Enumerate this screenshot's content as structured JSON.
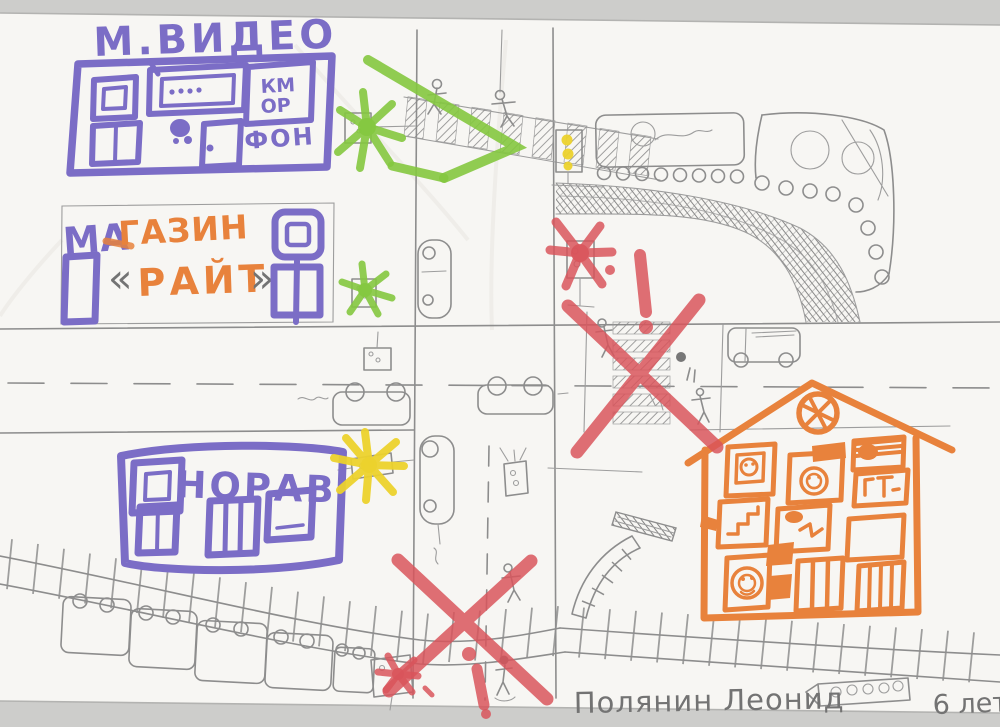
{
  "buildings": {
    "mvideo": {
      "title": "М.ВИДЕО",
      "sign_line1": "КМ",
      "sign_line2": "ОР",
      "sign_line3": "ФОН"
    },
    "magazin_rait": {
      "word_start": "МА",
      "word_end": "ГАЗИН",
      "line2": "РАЙТ",
      "chevron_left": "«",
      "chevron_right": "»"
    },
    "norav": {
      "title": "НОРАВ"
    }
  },
  "signature": {
    "name": "Полянин Леонид",
    "age": "6 лет"
  },
  "markers": [
    {
      "name": "green-arrow",
      "color": "#84c83f"
    },
    {
      "name": "green-star-top-traffic-light",
      "color": "#84c83f"
    },
    {
      "name": "green-star-mid-traffic-light",
      "color": "#84c83f"
    },
    {
      "name": "yellow-star-sign",
      "color": "#ecd22c"
    },
    {
      "name": "red-star-traffic-light",
      "color": "#d9535a"
    },
    {
      "name": "red-exclamation-crosswalk",
      "color": "#d9535a"
    },
    {
      "name": "red-x-crosswalk",
      "color": "#d9535a"
    },
    {
      "name": "red-x-railway-crossing",
      "color": "#d9535a"
    },
    {
      "name": "red-exclamation-railway",
      "color": "#d9535a"
    },
    {
      "name": "red-star-bottom-sign",
      "color": "#d9535a"
    }
  ],
  "colors": {
    "purple_marker": "#7b6dc6",
    "orange_marker": "#e8823c",
    "red_marker": "#d9535a",
    "green_marker": "#84c83f",
    "yellow_marker": "#ecd22c",
    "pencil": "#8d8d8d",
    "paper": "#f7f6f3",
    "scan_background": "#cdcdcb"
  }
}
